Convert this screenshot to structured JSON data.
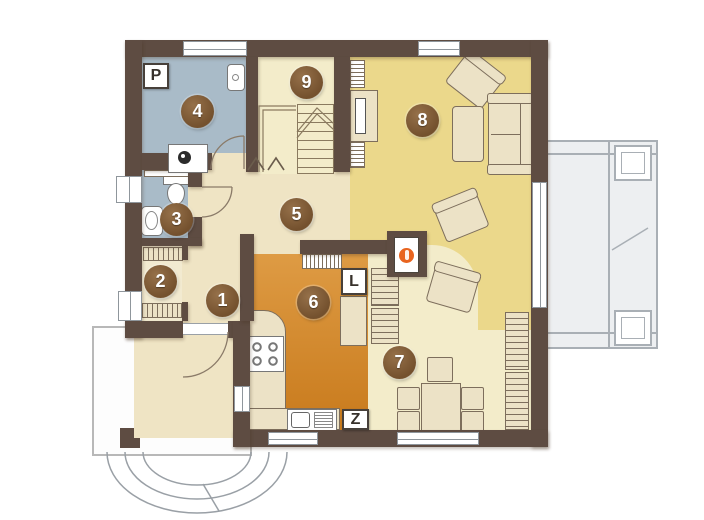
{
  "plan": {
    "type": "floor-plan",
    "rooms": [
      {
        "marker": "1"
      },
      {
        "marker": "2"
      },
      {
        "marker": "3"
      },
      {
        "marker": "4"
      },
      {
        "marker": "5"
      },
      {
        "marker": "6"
      },
      {
        "marker": "7"
      },
      {
        "marker": "8"
      },
      {
        "marker": "9"
      }
    ],
    "labels": {
      "p": "P",
      "l": "L",
      "z": "Z"
    }
  },
  "colors": {
    "wall": "#5e4c42",
    "bath": "#a9bbc8",
    "living": "#ebd88b",
    "pale": "#f3ecca",
    "hall": "#efe4c4",
    "room2": "#f2ead0",
    "kitchen1": "#de9b44",
    "kitchen2": "#c87a1c",
    "marker1": "#96714a",
    "marker2": "#74512e",
    "fire": "#e8641f",
    "terrace": "#edeff1",
    "terrace_line": "#a9afb5",
    "furn": "#ece2c6",
    "furn_line": "#7d6e5c",
    "win_line": "#8f969c"
  }
}
